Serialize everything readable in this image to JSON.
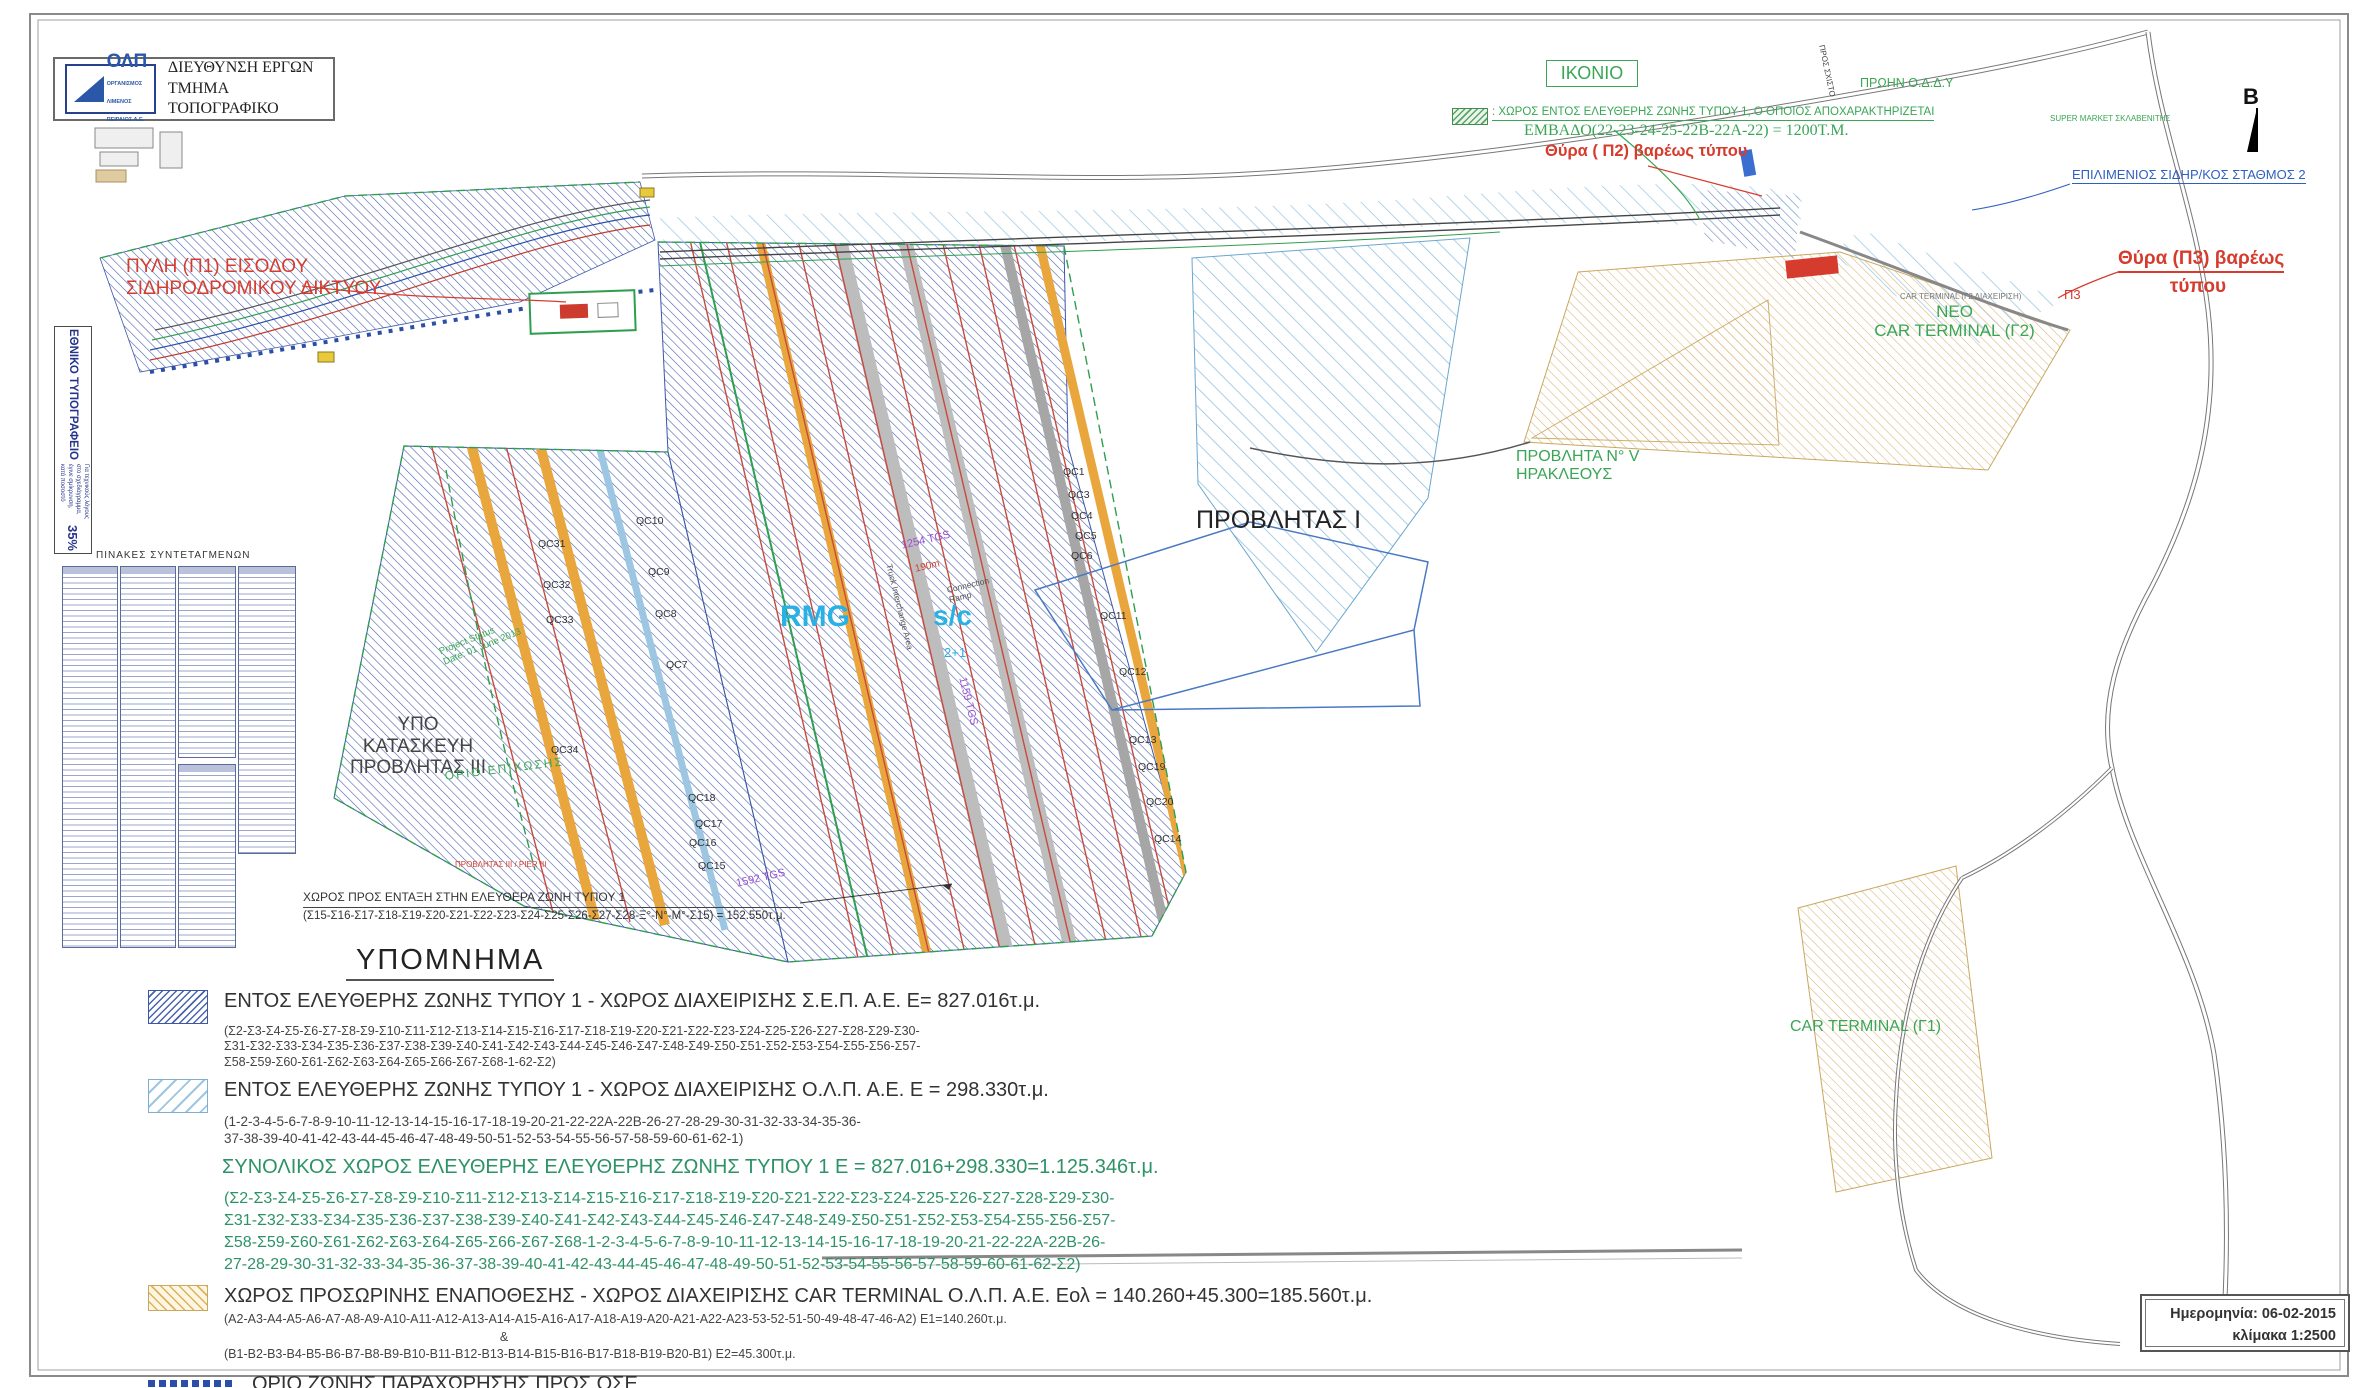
{
  "header": {
    "logo_text": "ΟΛΠ",
    "logo_sub": "ΟΡΓΑΝΙΣΜΟΣ\nΛΙΜΕΝΟΣ\nΠΕΙΡΑΙΩΣ Α.Ε.",
    "dept": "ΔΙΕΥΘΥΝΣΗ ΕΡΓΩΝ\nΤΜΗΜΑ ΤΟΠΟΓΡΑΦΙΚΟ"
  },
  "left_stamp": {
    "title": "ΕΘΝΙΚΟ ΤΥΠΟΓΡΑΦΕΙΟ",
    "note": "Για τεχνικούς λόγους στο σχεδιάγραμμα, έγινε σμίκρυνση, κατά ποσοστό",
    "percent": "35%"
  },
  "coord_tables": {
    "title": "ΠΙΝΑΚΕΣ  ΣΥΝΤΕΤΑΓΜΕΝΩΝ",
    "boxes": [
      {
        "x": 62,
        "y": 566,
        "w": 54,
        "h": 380
      },
      {
        "x": 120,
        "y": 566,
        "w": 54,
        "h": 380
      },
      {
        "x": 178,
        "y": 566,
        "w": 56,
        "h": 190
      },
      {
        "x": 178,
        "y": 764,
        "w": 56,
        "h": 182
      },
      {
        "x": 238,
        "y": 566,
        "w": 56,
        "h": 286
      }
    ]
  },
  "map": {
    "labels": [
      {
        "name": "label-pyli-p1",
        "text": "ΠΥΛΗ (Π1) ΕΙΣΟΔΟΥ\nΣΙΔΗΡΟΔΡΟΜΙΚΟΥ  ΔΙΚΤΥΟΥ",
        "x": 126,
        "y": 256,
        "fs": 19,
        "color": "#d63c2e"
      },
      {
        "name": "label-ikonio",
        "text": "ΙΚΟΝΙΟ",
        "x": 1546,
        "y": 60,
        "fs": 18,
        "color": "#3aa655",
        "cls": "boxed",
        "w": 70,
        "align": "center"
      },
      {
        "name": "label-free-zone-note",
        "text": ":  ΧΩΡΟΣ ΕΝΤΟΣ ΕΛΕΥΘΕΡΗΣ ΖΩΝΗΣ ΤΥΠΟΥ 1, Ο ΟΠΟΙΟΣ ΑΠΟΧΑΡΑΚΤΗΡΙΖΕΤΑΙ",
        "x": 1492,
        "y": 106,
        "fs": 11.5,
        "color": "#3aa655",
        "cls": "underl"
      },
      {
        "name": "label-embado",
        "text": "ΕΜΒΑΔΟ(22-23-24-25-22Β-22Α-22) = 1200Τ.Μ.",
        "x": 1524,
        "y": 122,
        "fs": 16,
        "color": "#3aa655",
        "serif": 1
      },
      {
        "name": "label-thyra-p2",
        "text": "Θύρα ( Π2) βαρέως τύπου",
        "x": 1545,
        "y": 142,
        "fs": 16.5,
        "color": "#d63c2e",
        "bold": 1
      },
      {
        "name": "label-proin-oddy",
        "text": "ΠΡΩΗΝ Ο.Δ.Δ.Υ",
        "x": 1860,
        "y": 76,
        "fs": 12.5,
        "color": "#3aa655"
      },
      {
        "name": "label-pros-sxisto",
        "text": "ΠΡΟΣ ΣΧΙΣΤΟ",
        "x": 1826,
        "y": 44,
        "fs": 8,
        "color": "#444",
        "rot": 78
      },
      {
        "name": "label-super-market",
        "text": "SUPER MARKET ΣΚΛΑΒΕΝΙΤΗΣ",
        "x": 2050,
        "y": 114,
        "fs": 8,
        "color": "#3aa655"
      },
      {
        "name": "label-north-b",
        "text": "B",
        "x": 2243,
        "y": 84,
        "fs": 22,
        "color": "#111",
        "bold": 1
      },
      {
        "name": "label-epilimenios",
        "text": "ΕΠΙΛΙΜΕΝΙΟΣ ΣΙΔΗΡ/ΚΟΣ ΣΤΑΘΜΟΣ 2",
        "x": 2072,
        "y": 168,
        "fs": 13,
        "color": "#2f5fc0",
        "cls": "underl2"
      },
      {
        "name": "label-thyra-p3-line1",
        "text": "Θύρα (Π3) βαρέως",
        "x": 2118,
        "y": 248,
        "fs": 19,
        "color": "#d63c2e",
        "bold": 1,
        "cls": "underl-red"
      },
      {
        "name": "label-thyra-p3-line2",
        "text": "τύπου",
        "x": 2118,
        "y": 276,
        "fs": 19,
        "color": "#d63c2e",
        "bold": 1,
        "w": 160,
        "align": "center"
      },
      {
        "name": "label-p3",
        "text": "Π3",
        "x": 2064,
        "y": 288,
        "fs": 13,
        "color": "#d63c2e"
      },
      {
        "name": "label-car-terminal-g2-note",
        "text": "CAR TERMINAL (Γ2  ΔΙΑΧΕΙΡΙΣΗ)",
        "x": 1900,
        "y": 292,
        "fs": 8,
        "color": "#777"
      },
      {
        "name": "label-neo-car-terminal-g2",
        "text": "NEO\nCAR TERMINAL (Γ2)",
        "x": 1862,
        "y": 302,
        "fs": 17,
        "color": "#3aa655",
        "w": 185,
        "align": "center"
      },
      {
        "name": "label-provlita-v",
        "text": "ΠΡΟΒΛΗΤΑ Ν° V\nΗΡΑΚΛΕΟΥΣ",
        "x": 1516,
        "y": 448,
        "fs": 16,
        "color": "#3aa655"
      },
      {
        "name": "label-provlitas-i",
        "text": "ΠΡΟΒΛΗΤΑΣ Ι",
        "x": 1196,
        "y": 506,
        "fs": 25,
        "color": "#222"
      },
      {
        "name": "label-rmg",
        "text": "RMG",
        "x": 780,
        "y": 600,
        "fs": 30,
        "color": "#29b1e6",
        "bold": 1
      },
      {
        "name": "label-sc",
        "text": "s/c",
        "x": 933,
        "y": 600,
        "fs": 28,
        "color": "#29b1e6",
        "bold": 1
      },
      {
        "name": "label-2plus1",
        "text": "2+1",
        "x": 944,
        "y": 646,
        "fs": 13,
        "color": "#29b1e6"
      },
      {
        "name": "label-1254-tgs",
        "text": "1254 TGS",
        "x": 900,
        "y": 540,
        "fs": 11,
        "color": "#9b4fd4",
        "rot": -13
      },
      {
        "name": "label-190m",
        "text": "190m",
        "x": 914,
        "y": 564,
        "fs": 10,
        "color": "#d63c2e",
        "rot": -13
      },
      {
        "name": "label-connection-ramp",
        "text": "Connection\nRamp",
        "x": 946,
        "y": 586,
        "fs": 8.5,
        "color": "#555",
        "rot": -13
      },
      {
        "name": "label-truck-interchange",
        "text": "Truck Interchange Area",
        "x": 893,
        "y": 563,
        "fs": 8.5,
        "color": "#555",
        "rot": 76
      },
      {
        "name": "label-1159-tgs",
        "text": "1159 TGS",
        "x": 968,
        "y": 676,
        "fs": 11,
        "color": "#9b4fd4",
        "rot": 76
      },
      {
        "name": "label-1592-tgs",
        "text": "1592 TGS",
        "x": 735,
        "y": 878,
        "fs": 11,
        "color": "#9b4fd4",
        "rot": -13
      },
      {
        "name": "label-ypo-kataskevi",
        "text": "ΥΠΟ ΚΑΤΑΣΚΕΥΗ\nΠΡΟΒΛΗΤΑΣ ΙΙΙ",
        "x": 348,
        "y": 714,
        "fs": 19,
        "color": "#444",
        "w": 140,
        "align": "center"
      },
      {
        "name": "label-orio-epichosis",
        "text": "ΟΡΙΟ ΕΠΙΧΩΣΗΣ",
        "x": 444,
        "y": 770,
        "fs": 12,
        "color": "#3aa655",
        "rot": -7,
        "ls": 2
      },
      {
        "name": "label-project-status",
        "text": "Project Status\nDate: 01 June 2013",
        "x": 438,
        "y": 648,
        "fs": 9.5,
        "color": "#3aa655",
        "rot": -22
      },
      {
        "name": "label-provlitas-iii-pier",
        "text": "ΠΡΟΒΛΗΤΑΣ ΙΙΙ / PIER ΙΙΙ",
        "x": 455,
        "y": 860,
        "fs": 8,
        "color": "#d63c2e"
      },
      {
        "name": "label-xoros-entaxi-line1",
        "text": "ΧΩΡΟΣ  ΠΡΟΣ ΕΝΤΑΞΗ  ΣΤΗΝ ΕΛΕΥΘΕΡΑ ΖΩΝΗ ΤΥΠΟΥ 1",
        "x": 303,
        "y": 891,
        "fs": 12,
        "color": "#333",
        "cls": "hr-under",
        "w": 500
      },
      {
        "name": "label-xoros-entaxi-line2",
        "text": "(Σ15-Σ16-Σ17-Σ18-Σ19-Σ20-Σ21-Σ22-Σ23-Σ24-Σ25-Σ26-Σ27-Σ28-Ξ°-Ν°-Μ°-Σ15)  =  152.550τ.μ.",
        "x": 303,
        "y": 910,
        "fs": 11.5,
        "color": "#333"
      },
      {
        "name": "label-car-terminal-g1",
        "text": "CAR TERMINAL (Γ1)",
        "x": 1790,
        "y": 1018,
        "fs": 16,
        "color": "#3aa655"
      }
    ],
    "qc_labels": [
      {
        "t": "QC1",
        "x": 1063,
        "y": 466
      },
      {
        "t": "QC3",
        "x": 1068,
        "y": 489
      },
      {
        "t": "QC4",
        "x": 1071,
        "y": 510
      },
      {
        "t": "QC5",
        "x": 1075,
        "y": 530
      },
      {
        "t": "QC6",
        "x": 1071,
        "y": 550
      },
      {
        "t": "QC10",
        "x": 636,
        "y": 515
      },
      {
        "t": "QC9",
        "x": 648,
        "y": 566
      },
      {
        "t": "QC8",
        "x": 655,
        "y": 608
      },
      {
        "t": "QC7",
        "x": 666,
        "y": 659
      },
      {
        "t": "QC11",
        "x": 1100,
        "y": 610
      },
      {
        "t": "QC12",
        "x": 1119,
        "y": 666
      },
      {
        "t": "QC13",
        "x": 1129,
        "y": 734
      },
      {
        "t": "QC19",
        "x": 1138,
        "y": 761
      },
      {
        "t": "QC20",
        "x": 1146,
        "y": 796
      },
      {
        "t": "QC14",
        "x": 1154,
        "y": 833
      },
      {
        "t": "QC18",
        "x": 688,
        "y": 792
      },
      {
        "t": "QC17",
        "x": 695,
        "y": 818
      },
      {
        "t": "QC16",
        "x": 689,
        "y": 837
      },
      {
        "t": "QC15",
        "x": 698,
        "y": 860
      },
      {
        "t": "QC31",
        "x": 538,
        "y": 538
      },
      {
        "t": "QC32",
        "x": 543,
        "y": 579
      },
      {
        "t": "QC33",
        "x": 546,
        "y": 614
      },
      {
        "t": "QC34",
        "x": 551,
        "y": 744
      }
    ]
  },
  "legend": {
    "title": "ΥΠΟΜΝΗΜΑ",
    "items": [
      {
        "type": "sep",
        "title": "ΕΝΤΟΣ ΕΛΕΥΘΕΡΗΣ ΖΩΝΗΣ ΤΥΠΟΥ 1 - ΧΩΡΟΣ ΔΙΑΧΕΙΡΙΣΗΣ Σ.Ε.Π. Α.Ε.    Ε= 827.016τ.μ.",
        "details": [
          "(Σ2-Σ3-Σ4-Σ5-Σ6-Σ7-Σ8-Σ9-Σ10-Σ11-Σ12-Σ13-Σ14-Σ15-Σ16-Σ17-Σ18-Σ19-Σ20-Σ21-Σ22-Σ23-Σ24-Σ25-Σ26-Σ27-Σ28-Σ29-Σ30-",
          "Σ31-Σ32-Σ33-Σ34-Σ35-Σ36-Σ37-Σ38-Σ39-Σ40-Σ41-Σ42-Σ43-Σ44-Σ45-Σ46-Σ47-Σ48-Σ49-Σ50-Σ51-Σ52-Σ53-Σ54-Σ55-Σ56-Σ57-",
          "Σ58-Σ59-Σ60-Σ61-Σ62-Σ63-Σ64-Σ65-Σ66-Σ67-Σ68-1-62-Σ2)"
        ]
      },
      {
        "type": "olp",
        "title": "ΕΝΤΟΣ ΕΛΕΥΘΕΡΗΣ ΖΩΝΗΣ ΤΥΠΟΥ 1 - ΧΩΡΟΣ ΔΙΑΧΕΙΡΙΣΗΣ Ο.Λ.Π. Α.Ε.  Ε = 298.330τ.μ.",
        "details": [
          "(1-2-3-4-5-6-7-8-9-10-11-12-13-14-15-16-17-18-19-20-21-22-22Α-22Β-26-27-28-29-30-31-32-33-34-35-36-",
          "37-38-39-40-41-42-43-44-45-46-47-48-49-50-51-52-53-54-55-56-57-58-59-60-61-62-1)"
        ]
      },
      {
        "type": "total",
        "title": "ΣΥΝΟΛΙΚΟΣ ΧΩΡΟΣ ΕΛΕΥΘΕΡΗΣ ΕΛΕΥΘΕΡΗΣ ΖΩΝΗΣ ΤΥΠΟΥ 1  Ε = 827.016+298.330=1.125.346τ.μ.",
        "details": [
          "(Σ2-Σ3-Σ4-Σ5-Σ6-Σ7-Σ8-Σ9-Σ10-Σ11-Σ12-Σ13-Σ14-Σ15-Σ16-Σ17-Σ18-Σ19-Σ20-Σ21-Σ22-Σ23-Σ24-Σ25-Σ26-Σ27-Σ28-Σ29-Σ30-",
          "Σ31-Σ32-Σ33-Σ34-Σ35-Σ36-Σ37-Σ38-Σ39-Σ40-Σ41-Σ42-Σ43-Σ44-Σ45-Σ46-Σ47-Σ48-Σ49-Σ50-Σ51-Σ52-Σ53-Σ54-Σ55-Σ56-Σ57-",
          "Σ58-Σ59-Σ60-Σ61-Σ62-Σ63-Σ64-Σ65-Σ66-Σ67-Σ68-1-2-3-4-5-6-7-8-9-10-11-12-13-14-15-16-17-18-19-20-21-22-22Α-22Β-26-",
          "27-28-29-30-31-32-33-34-35-36-37-38-39-40-41-42-43-44-45-46-47-48-49-50-51-52-53-54-55-56-57-58-59-60-61-62-Σ2)"
        ]
      },
      {
        "type": "car",
        "title": "ΧΩΡΟΣ ΠΡΟΣΩΡΙΝΗΣ ΕΝΑΠΟΘΕΣΗΣ  - ΧΩΡΟΣ ΔΙΑΧΕΙΡΙΣΗΣ CAR TERMINAL Ο.Λ.Π. Α.Ε.   Εολ = 140.260+45.300=185.560τ.μ.",
        "details": [
          "(Α2-Α3-Α4-Α5-Α6-Α7-Α8-Α9-Α10-Α11-Α12-Α13-Α14-Α15-Α16-Α17-Α18-Α19-Α20-Α21-Α22-Α23-53-52-51-50-49-48-47-46-Α2)   Ε1=140.260τ.μ.",
          "&",
          "(Β1-Β2-Β3-Β4-Β5-Β6-Β7-Β8-Β9-Β10-Β11-Β12-Β13-Β14-Β15-Β16-Β17-Β18-Β19-Β20-Β1)   Ε2=45.300τ.μ."
        ]
      },
      {
        "type": "ose",
        "title": "ΟΡΙΟ ΖΩΝΗΣ ΠΑΡΑΧΩΡΗΣΗΣ ΠΡΟΣ ΟΣΕ",
        "details": []
      }
    ]
  },
  "titleblock": {
    "date": "Ημερομηνία: 06-02-2015",
    "scale": "κλίμακα   1:2500"
  },
  "colors": {
    "sep_hatch": "#4a63ae",
    "olp_hatch": "#93c3e0",
    "car_hatch": "#dcb77c",
    "red": "#d63c2e",
    "green": "#3aa655",
    "blue": "#2f5fc0",
    "cyan": "#29b1e6"
  }
}
